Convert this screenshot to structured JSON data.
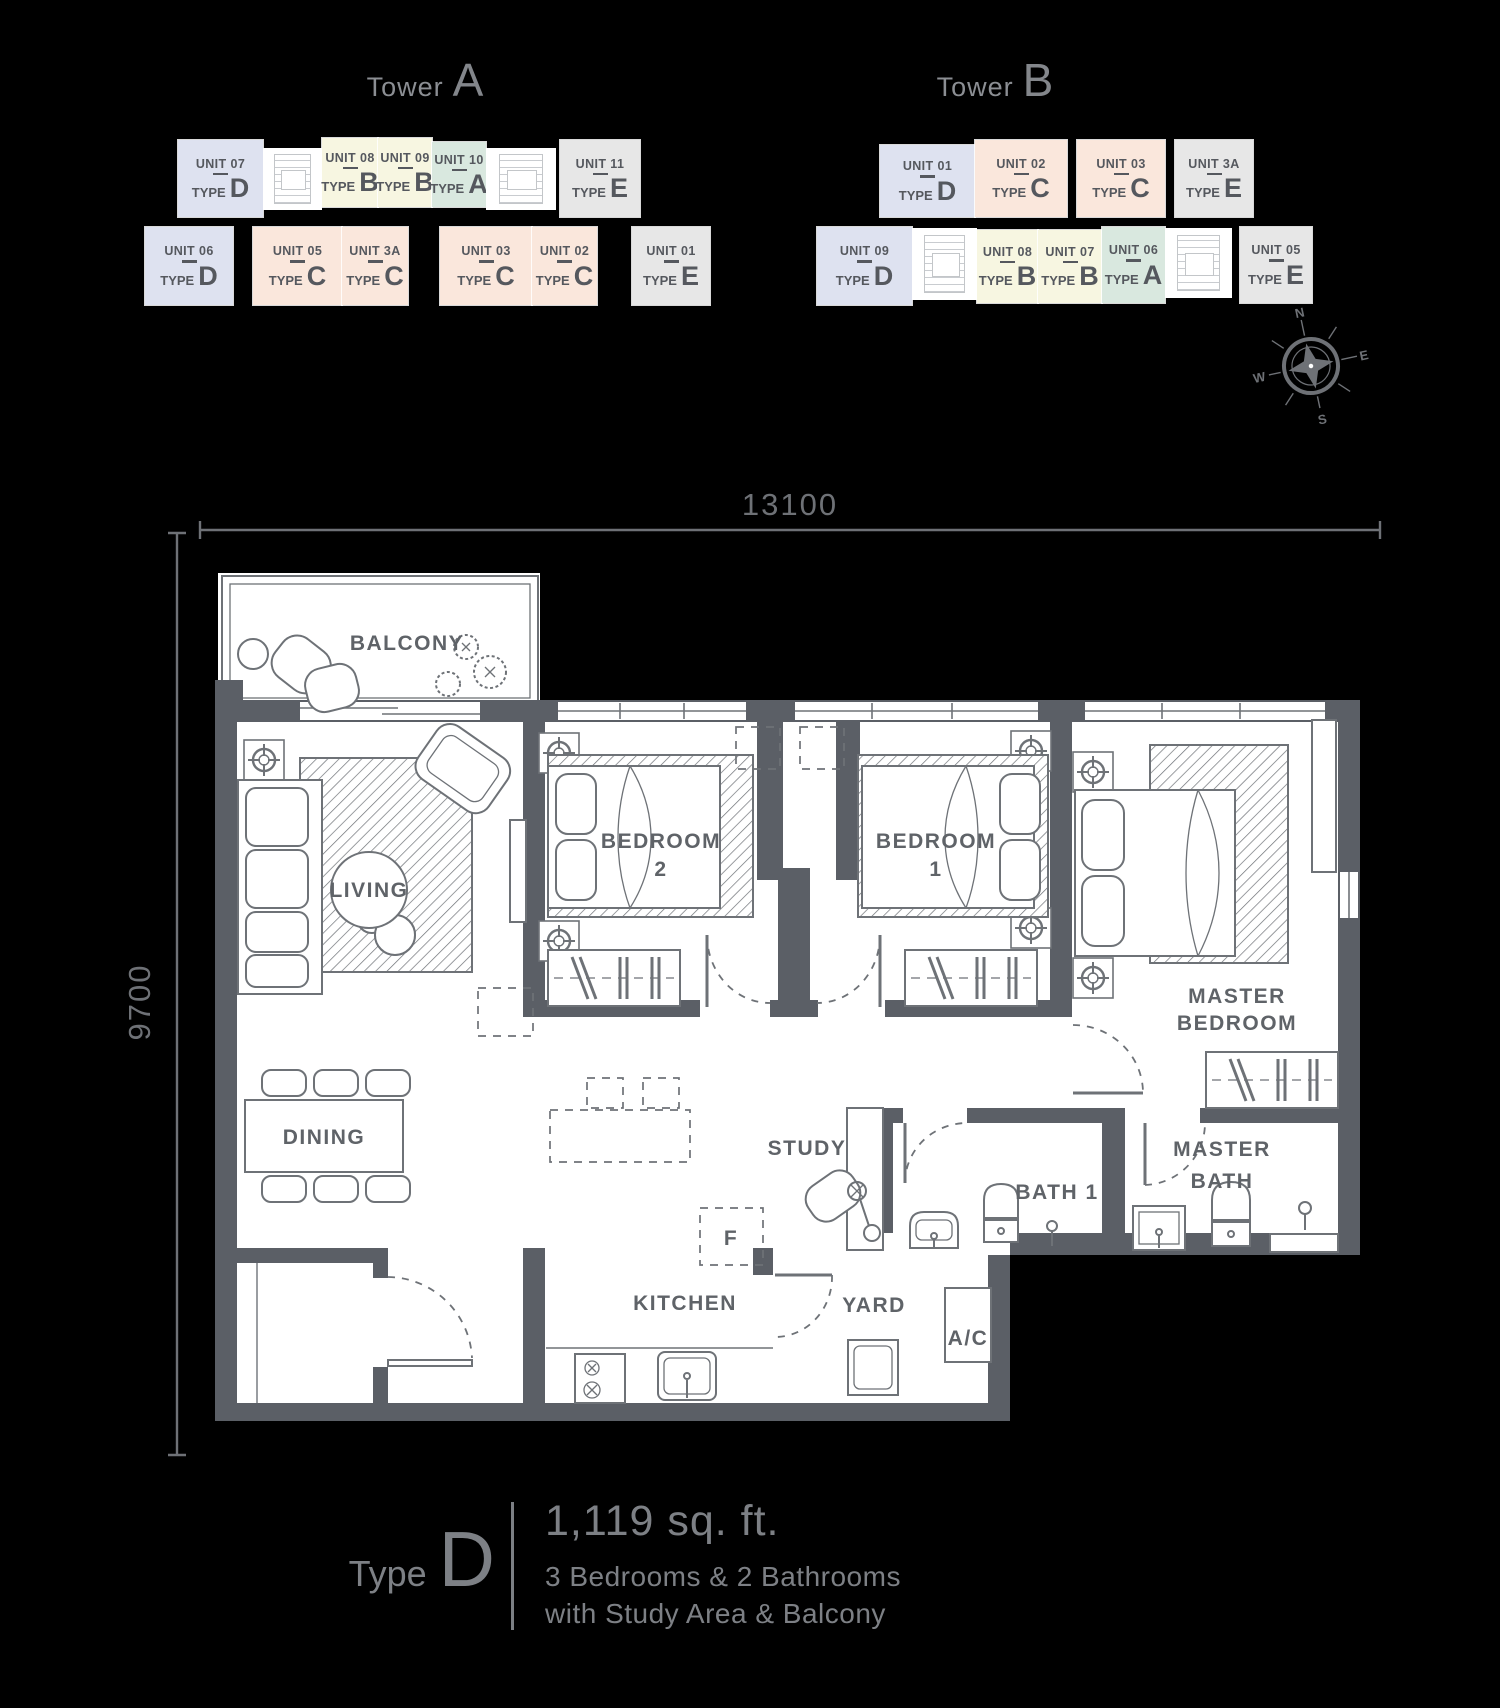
{
  "towers": {
    "type_word": "TYPE",
    "a": {
      "name": "Tower",
      "letter": "A",
      "units": [
        {
          "unit": "UNIT 07",
          "type": "D"
        },
        {
          "unit": "UNIT 08",
          "type": "B"
        },
        {
          "unit": "UNIT 09",
          "type": "B"
        },
        {
          "unit": "UNIT 10",
          "type": "A"
        },
        {
          "unit": "UNIT 11",
          "type": "E"
        },
        {
          "unit": "UNIT 06",
          "type": "D"
        },
        {
          "unit": "UNIT 05",
          "type": "C"
        },
        {
          "unit": "UNIT 3A",
          "type": "C"
        },
        {
          "unit": "UNIT 03",
          "type": "C"
        },
        {
          "unit": "UNIT 02",
          "type": "C"
        },
        {
          "unit": "UNIT 01",
          "type": "E"
        }
      ]
    },
    "b": {
      "name": "Tower",
      "letter": "B",
      "units": [
        {
          "unit": "UNIT 01",
          "type": "D"
        },
        {
          "unit": "UNIT 02",
          "type": "C"
        },
        {
          "unit": "UNIT 03",
          "type": "C"
        },
        {
          "unit": "UNIT 3A",
          "type": "E"
        },
        {
          "unit": "UNIT 09",
          "type": "D"
        },
        {
          "unit": "UNIT 08",
          "type": "B"
        },
        {
          "unit": "UNIT 07",
          "type": "B"
        },
        {
          "unit": "UNIT 06",
          "type": "A"
        },
        {
          "unit": "UNIT 05",
          "type": "E"
        }
      ]
    }
  },
  "compass": {
    "n": "N",
    "e": "E",
    "w": "W",
    "s": "S"
  },
  "dimensions": {
    "width": "13100",
    "height": "9700"
  },
  "rooms": {
    "balcony": "BALCONY",
    "living": "LIVING",
    "dining": "DINING",
    "kitchen": "KITCHEN",
    "yard": "YARD",
    "study": "STUDY",
    "bedroom2_l1": "BEDROOM",
    "bedroom2_l2": "2",
    "bedroom1_l1": "BEDROOM",
    "bedroom1_l2": "1",
    "master_l1": "MASTER",
    "master_l2": "BEDROOM",
    "bath1": "BATH 1",
    "masterbath_l1": "MASTER",
    "masterbath_l2": "BATH",
    "ac": "A/C",
    "fridge": "F"
  },
  "caption": {
    "type_word": "Type",
    "type_letter": "D",
    "area": "1,119 sq. ft.",
    "line1": "3 Bedrooms & 2 Bathrooms",
    "line2": "with Study Area & Balcony"
  },
  "colors": {
    "type_a": "#d9e8df",
    "type_b": "#f7f6e1",
    "type_c": "#fae7dc",
    "type_d": "#dee2f0",
    "type_e": "#e7e7e7",
    "wall": "#5b5f66",
    "line": "#6e7277",
    "label": "#5f6368",
    "dim": "#6e7176",
    "background": "#000000"
  }
}
